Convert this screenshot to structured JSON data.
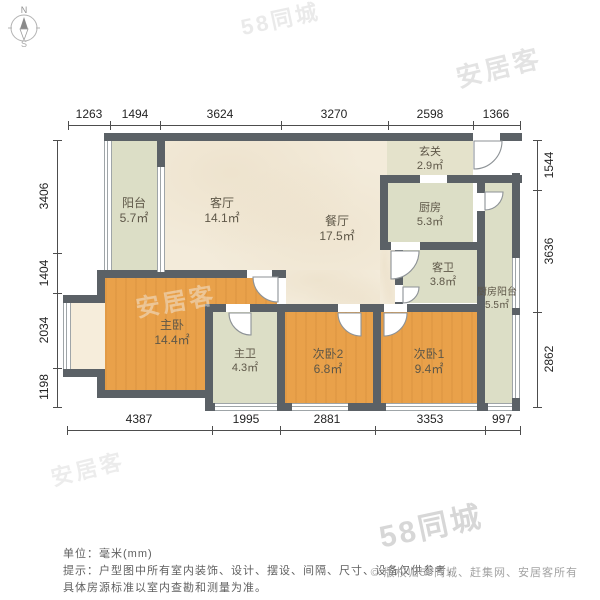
{
  "compass": {
    "north": "N",
    "south": "S"
  },
  "rooms": {
    "balcony": {
      "name": "阳台",
      "area": "5.7㎡"
    },
    "living": {
      "name": "客厅",
      "area": "14.1㎡"
    },
    "dining": {
      "name": "餐厅",
      "area": "17.5㎡"
    },
    "entry": {
      "name": "玄关",
      "area": "2.9㎡"
    },
    "kitchen": {
      "name": "厨房",
      "area": "5.3㎡"
    },
    "guest_bath": {
      "name": "客卫",
      "area": "3.8㎡"
    },
    "kitchen_balcony": {
      "name": "厨房阳台",
      "area": "5.5㎡"
    },
    "master_bedroom": {
      "name": "主卧",
      "area": "14.4㎡"
    },
    "master_bath": {
      "name": "主卫",
      "area": "4.3㎡"
    },
    "bedroom2": {
      "name": "次卧2",
      "area": "6.8㎡"
    },
    "bedroom1": {
      "name": "次卧1",
      "area": "9.4㎡"
    }
  },
  "dimensions": {
    "top": [
      "1263",
      "1494",
      "3624",
      "3270",
      "2598",
      "1366"
    ],
    "bottom": [
      "4387",
      "1995",
      "2881",
      "3353",
      "997"
    ],
    "left": [
      "3406",
      "1404",
      "2034",
      "1198"
    ],
    "right": [
      "1544",
      "3636",
      "2862"
    ]
  },
  "watermarks": [
    "58同城",
    "安居客",
    "安居客",
    "安居客",
    "58同城"
  ],
  "footer": {
    "unit": "单位：毫米(mm)",
    "note1": "提示：户型图中所有室内装饰、设计、摆设、间隔、尺寸、设备仅供参考，",
    "note2": "具体房源标准以室内查勘和测量为准。",
    "copyright": "© 版权归58同城、赶集网、安居客所有"
  },
  "colors": {
    "wall": "#5b6166",
    "wood_floor": "#e9a14a",
    "tile_floor": "#dcdec6",
    "marble_floor": "#f3ebda"
  }
}
